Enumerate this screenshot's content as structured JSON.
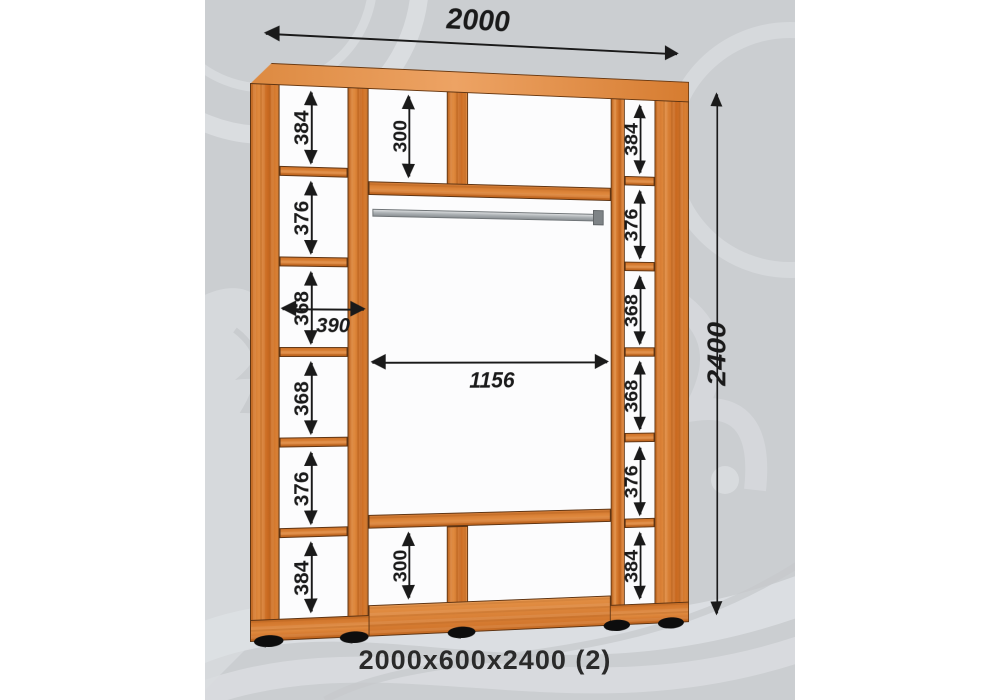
{
  "page": {
    "caption": "2000x600x2400 (2)"
  },
  "panel": {
    "background": "#cbced1",
    "pattern_color": "#dde0e2"
  },
  "cabinet": {
    "wood_color": "#d4772e",
    "wood_dark": "#b65d1d",
    "outline": "#5e3413",
    "rod_color": "#9ba0a4",
    "interior": "#fcfcfd",
    "dimension_color": "#1a1a1a"
  },
  "dimensions": {
    "overall_width": "2000",
    "overall_height": "2400",
    "opening_width": "1156",
    "shelf_depth": "390",
    "top_section": "300",
    "bottom_section": "300",
    "left_column": [
      "384",
      "376",
      "368",
      "368",
      "376",
      "384"
    ],
    "right_column": [
      "384",
      "376",
      "368",
      "368",
      "376",
      "384"
    ]
  }
}
